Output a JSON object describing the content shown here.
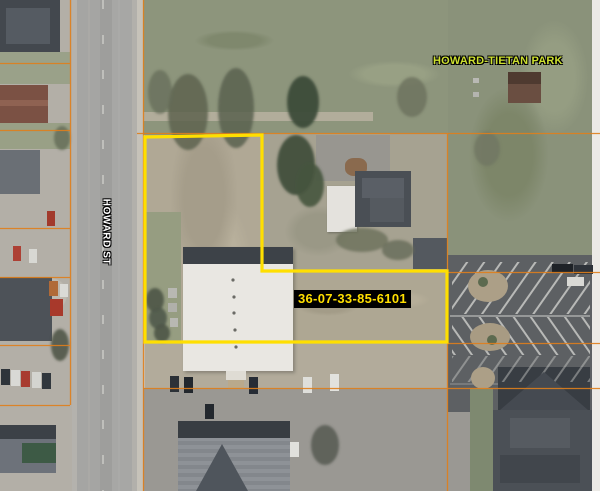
{
  "labels": {
    "park": "HOWARD-TIETAN PARK",
    "street": "HOWARD ST",
    "parcel_id": "36-07-33-85-6101"
  },
  "colors": {
    "parcel_boundary": "#ffdf00",
    "parcel_line": "#df7f1c",
    "park_label_text": "#cde030",
    "street_label_text": "#ffffff",
    "parcel_label_text": "#ffdf00",
    "parcel_label_bg": "#000000",
    "park_grass": "#8d957c",
    "parcel_ground": "#b0a895",
    "road_asphalt": "#a5a5a3",
    "parking_asphalt": "#5d6063",
    "white_roof": "#e9e7e2",
    "dark_roof": "#43484e"
  }
}
